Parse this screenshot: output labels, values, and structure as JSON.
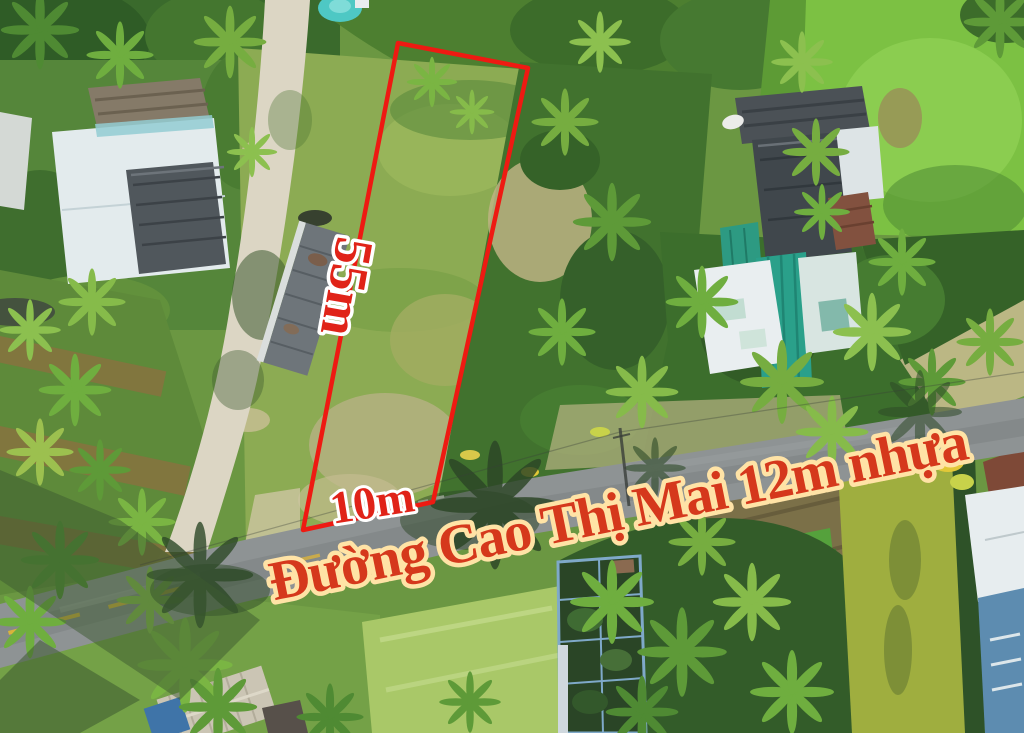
{
  "annotations": {
    "plot": {
      "outline_points": "398,43 528,68 433,502 303,530",
      "outline_color": "#ee1a12",
      "depth_label": "55m",
      "frontage_label": "10m",
      "dimension_fill": "#e02318",
      "dimension_outline": "#ffffff"
    },
    "road": {
      "name_label": "Đường Cao Thị Mai 12m nhựa",
      "label_fill": "#d5381c",
      "label_outline": "#ffe3a6"
    }
  }
}
